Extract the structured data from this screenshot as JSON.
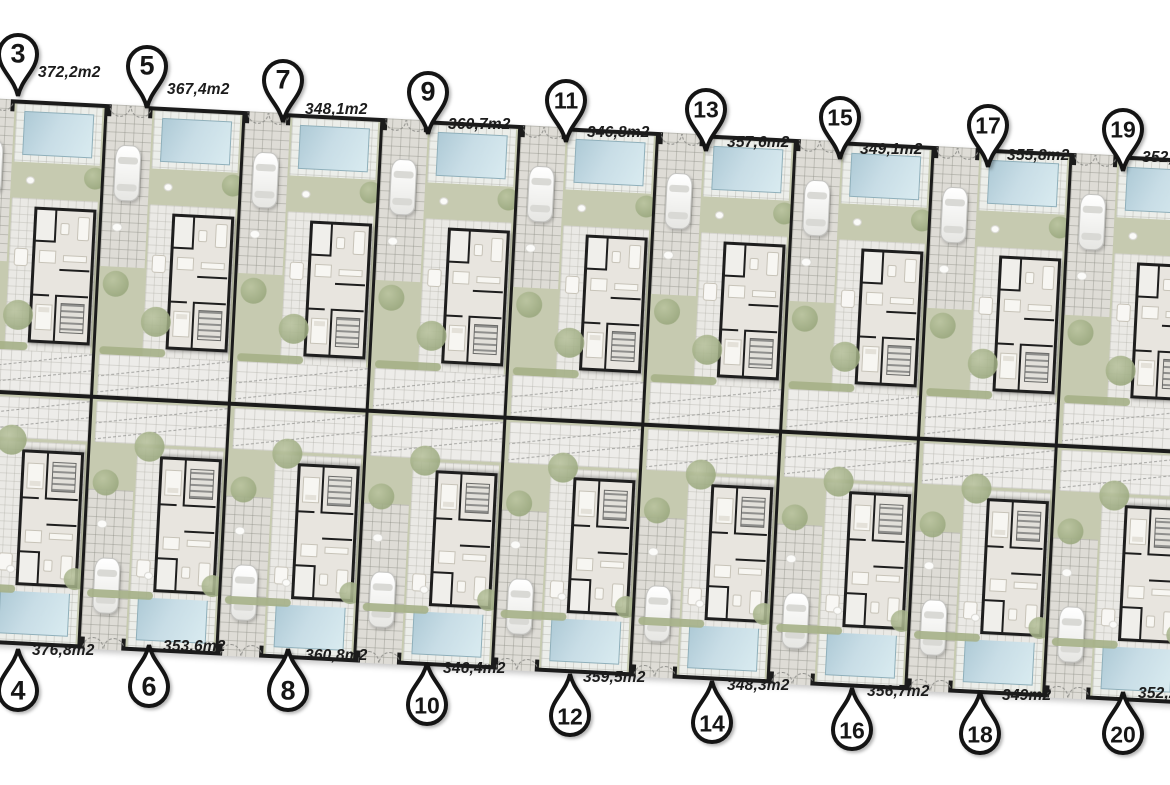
{
  "title": "villa development site plan",
  "colors": {
    "wall": "#1b1b1b",
    "garden": "#c6cab0",
    "pool_light": "#d9ebf0",
    "pool_dark": "#aecad6",
    "tile": "#eae9e5",
    "pin_fill": "#ffffff",
    "pin_stroke": "#141414",
    "label_text": "#1c1c1c"
  },
  "plots": [
    {
      "number": "3",
      "area": "372,2m2",
      "row": "top",
      "col": 0,
      "pin": {
        "x": 18,
        "y": 96
      },
      "label": {
        "x": 38,
        "y": 64
      }
    },
    {
      "number": "5",
      "area": "367,4m2",
      "row": "top",
      "col": 1,
      "pin": {
        "x": 147,
        "y": 108
      },
      "label": {
        "x": 167,
        "y": 81
      }
    },
    {
      "number": "7",
      "area": "348,1m2",
      "row": "top",
      "col": 2,
      "pin": {
        "x": 283,
        "y": 122
      },
      "label": {
        "x": 305,
        "y": 101
      }
    },
    {
      "number": "9",
      "area": "360,7m2",
      "row": "top",
      "col": 3,
      "pin": {
        "x": 428,
        "y": 134
      },
      "label": {
        "x": 448,
        "y": 116
      }
    },
    {
      "number": "11",
      "area": "346,8m2",
      "row": "top",
      "col": 4,
      "pin": {
        "x": 566,
        "y": 142
      },
      "label": {
        "x": 587,
        "y": 124
      }
    },
    {
      "number": "13",
      "area": "357,6m2",
      "row": "top",
      "col": 5,
      "pin": {
        "x": 706,
        "y": 151
      },
      "label": {
        "x": 727,
        "y": 134
      }
    },
    {
      "number": "15",
      "area": "349,1m2",
      "row": "top",
      "col": 6,
      "pin": {
        "x": 840,
        "y": 159
      },
      "label": {
        "x": 860,
        "y": 141
      }
    },
    {
      "number": "17",
      "area": "355,8m2",
      "row": "top",
      "col": 7,
      "pin": {
        "x": 988,
        "y": 167
      },
      "label": {
        "x": 1007,
        "y": 147
      }
    },
    {
      "number": "19",
      "area": "352,6m2",
      "row": "top",
      "col": 8,
      "pin": {
        "x": 1123,
        "y": 171
      },
      "label": {
        "x": 1142,
        "y": 149
      }
    },
    {
      "number": "4",
      "area": "376,8m2",
      "row": "bottom",
      "col": 0,
      "pin": {
        "x": 18,
        "y": 649
      },
      "label": {
        "x": 32,
        "y": 642
      }
    },
    {
      "number": "6",
      "area": "353,6m2",
      "row": "bottom",
      "col": 1,
      "pin": {
        "x": 149,
        "y": 645
      },
      "label": {
        "x": 163,
        "y": 638
      }
    },
    {
      "number": "8",
      "area": "360,8m2",
      "row": "bottom",
      "col": 2,
      "pin": {
        "x": 288,
        "y": 649
      },
      "label": {
        "x": 305,
        "y": 647
      }
    },
    {
      "number": "10",
      "area": "346,4m2",
      "row": "bottom",
      "col": 3,
      "pin": {
        "x": 427,
        "y": 663
      },
      "label": {
        "x": 443,
        "y": 660
      }
    },
    {
      "number": "12",
      "area": "359,5m2",
      "row": "bottom",
      "col": 4,
      "pin": {
        "x": 570,
        "y": 674
      },
      "label": {
        "x": 583,
        "y": 669
      }
    },
    {
      "number": "14",
      "area": "348,3m2",
      "row": "bottom",
      "col": 5,
      "pin": {
        "x": 712,
        "y": 681
      },
      "label": {
        "x": 727,
        "y": 677
      }
    },
    {
      "number": "16",
      "area": "356,7m2",
      "row": "bottom",
      "col": 6,
      "pin": {
        "x": 852,
        "y": 688
      },
      "label": {
        "x": 867,
        "y": 683
      }
    },
    {
      "number": "18",
      "area": "349m2",
      "row": "bottom",
      "col": 7,
      "pin": {
        "x": 980,
        "y": 692
      },
      "label": {
        "x": 1002,
        "y": 687
      }
    },
    {
      "number": "20",
      "area": "352,2m2",
      "row": "bottom",
      "col": 8,
      "pin": {
        "x": 1123,
        "y": 692
      },
      "label": {
        "x": 1138,
        "y": 685
      }
    }
  ]
}
